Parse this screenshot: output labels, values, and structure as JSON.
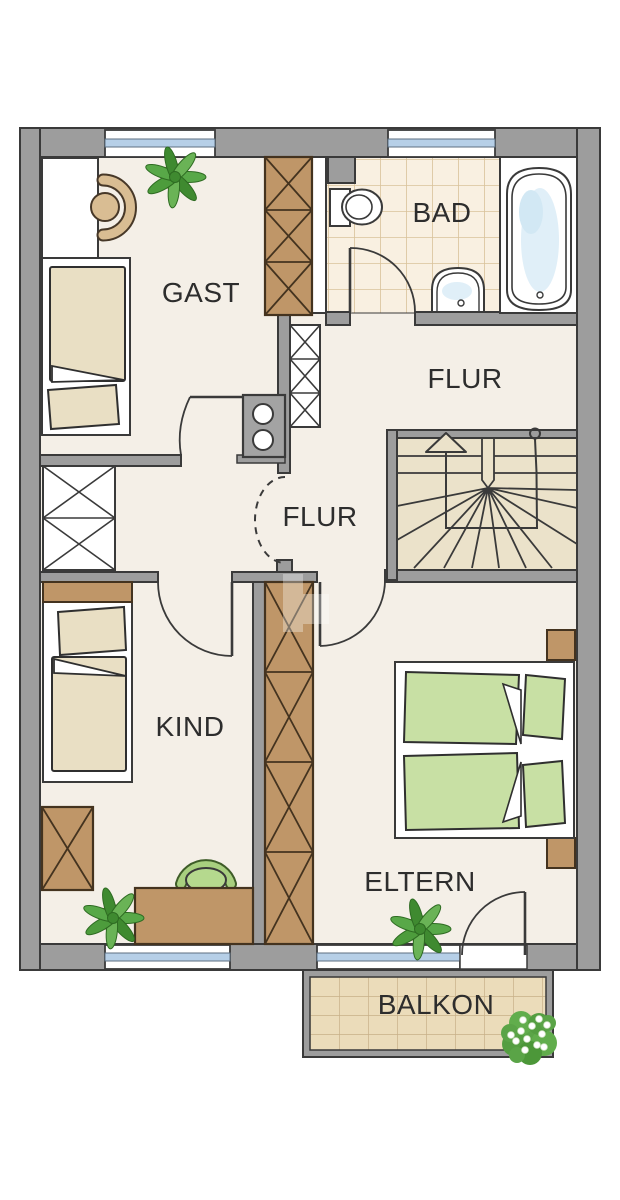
{
  "app": {
    "type": "apartment-floor-plan",
    "floor_shown": "upper floor"
  },
  "rooms": [
    {
      "id": "gast",
      "label": "GAST",
      "furniture": [
        "single-bed",
        "desk",
        "chair",
        "plant",
        "wardrobe"
      ]
    },
    {
      "id": "bad",
      "label": "BAD",
      "furniture": [
        "toilet",
        "sink",
        "bathtub",
        "tiled-floor"
      ]
    },
    {
      "id": "flur-top",
      "label": "FLUR",
      "furniture": [
        "staircase",
        "stair-direction-arrow"
      ]
    },
    {
      "id": "flur-mitte",
      "label": "FLUR",
      "furniture": [
        "chimney-shaft",
        "shelf-cabinet"
      ]
    },
    {
      "id": "kind",
      "label": "KIND",
      "furniture": [
        "single-bed",
        "desk",
        "chair",
        "cabinet",
        "plant",
        "wardrobe"
      ]
    },
    {
      "id": "eltern",
      "label": "ELTERN",
      "furniture": [
        "double-bed",
        "two-nightstands",
        "plant"
      ]
    },
    {
      "id": "balkon",
      "label": "BALKON",
      "furniture": [
        "flowering-plant",
        "tiled-deck"
      ]
    }
  ],
  "colors": {
    "wall_gray": "#9d9d9d",
    "outline_dark": "#3a3a3a",
    "floor_cream": "#f4efe7",
    "stairs_floor": "#ebe2ca",
    "bath_tile": "#f9f0e1",
    "bath_tile_line": "#d9c29a",
    "balcony_tile": "#ebdcba",
    "wood_brown": "#bf9668",
    "bedding_cream": "#e9dfc4",
    "mattress_green": "#c8e0a4",
    "chair_green": "#b5d98e",
    "chair_tan": "#d9bd93",
    "window_blue": "#b6cfe7",
    "water_blue": "#e0eff8",
    "plant_green": "#4d9c3c",
    "label_text": "#2d2d2d"
  }
}
